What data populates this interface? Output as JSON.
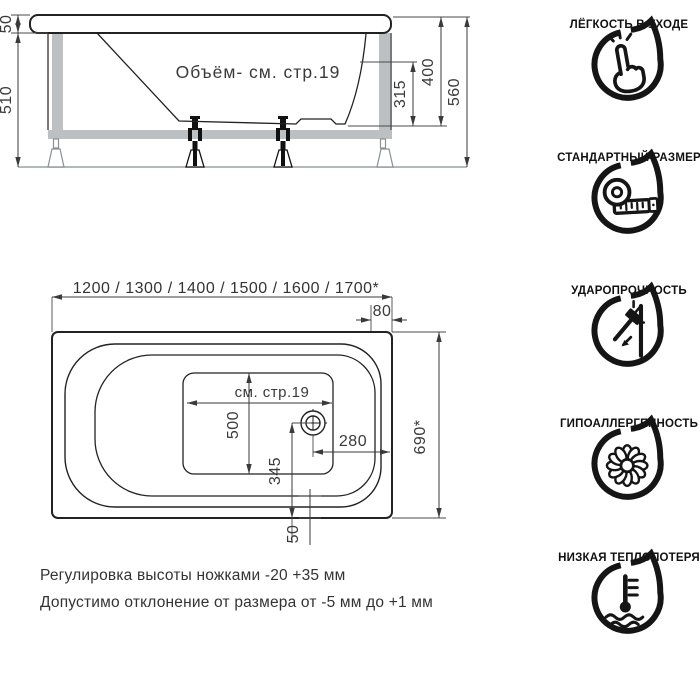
{
  "side_view": {
    "volume_note": "Объём- см. стр.19",
    "dim_rim_thickness": "50",
    "dim_frame_height": "510",
    "dim_inner_depth": "315",
    "dim_depth": "400",
    "dim_total_height": "560"
  },
  "top_view": {
    "dim_lengths": "1200 / 1300 / 1400 / 1500 / 1600 / 1700*",
    "dim_head_rim": "80",
    "see_page": "см. стр.19",
    "dim_bottom_width": "500",
    "dim_drain_offset": "345",
    "dim_drain_from_end": "280",
    "dim_width": "690*",
    "dim_rim_gap": "50"
  },
  "notes": {
    "line1": "Регулировка высоты ножками -20 +35 мм",
    "line2": "Допустимо отклонение от размера от -5 мм до +1 мм"
  },
  "features": [
    {
      "icon": "hand-click-icon",
      "label": "ЛЁГКОСТЬ В УХОДЕ"
    },
    {
      "icon": "tape-measure-icon",
      "label": "СТАНДАРТНЫЙ РАЗМЕР"
    },
    {
      "icon": "hammer-impact-icon",
      "label": "УДАРОПРОЧНОСТЬ"
    },
    {
      "icon": "flower-icon",
      "label": "ГИПОАЛЛЕРГЕННОСТЬ"
    },
    {
      "icon": "thermometer-icon",
      "label": "НИЗКАЯ ТЕПЛОПОТЕРЯ"
    }
  ],
  "colors": {
    "line": "#222222",
    "frame_gray": "#bcc0c2",
    "dim_text": "#3a3a3a"
  }
}
